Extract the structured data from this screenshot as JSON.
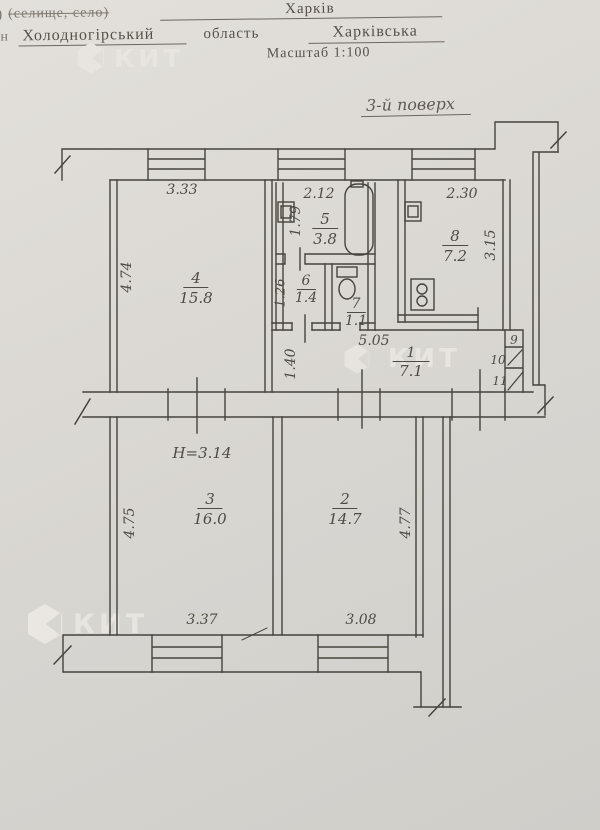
{
  "header": {
    "corner_fragment": ")",
    "settlement_label": "(селище, село)",
    "city": "Харків",
    "margin_fragment": "н",
    "district": "Холодногірський",
    "region_label": "область",
    "region": "Харківська",
    "scale": "Масштаб 1:100",
    "floor": "3-й поверх"
  },
  "watermark": {
    "text": "КИТ"
  },
  "labels": {
    "r4": {
      "num": "4",
      "area": "15.8",
      "w": "3.33",
      "h": "4.74"
    },
    "r5": {
      "num": "5",
      "area": "3.8",
      "w": "2.12",
      "h": "1.79"
    },
    "r6": {
      "num": "6",
      "area": "1.4",
      "h": "1.26"
    },
    "r7": {
      "num": "7",
      "area": "1.1"
    },
    "r8": {
      "num": "8",
      "area": "7.2",
      "w": "2.30",
      "h": "3.15"
    },
    "r1": {
      "num": "1",
      "area": "7.1",
      "w": "5.05",
      "h": "1.40"
    },
    "r3": {
      "num": "3",
      "area": "16.0",
      "w": "3.37",
      "h": "4.75",
      "ceiling": "H=3.14"
    },
    "r2": {
      "num": "2",
      "area": "14.7",
      "w": "3.08",
      "h": "4.77"
    },
    "c9": {
      "num": "9"
    },
    "c10": {
      "num": "10"
    },
    "c11": {
      "num": "11"
    }
  }
}
